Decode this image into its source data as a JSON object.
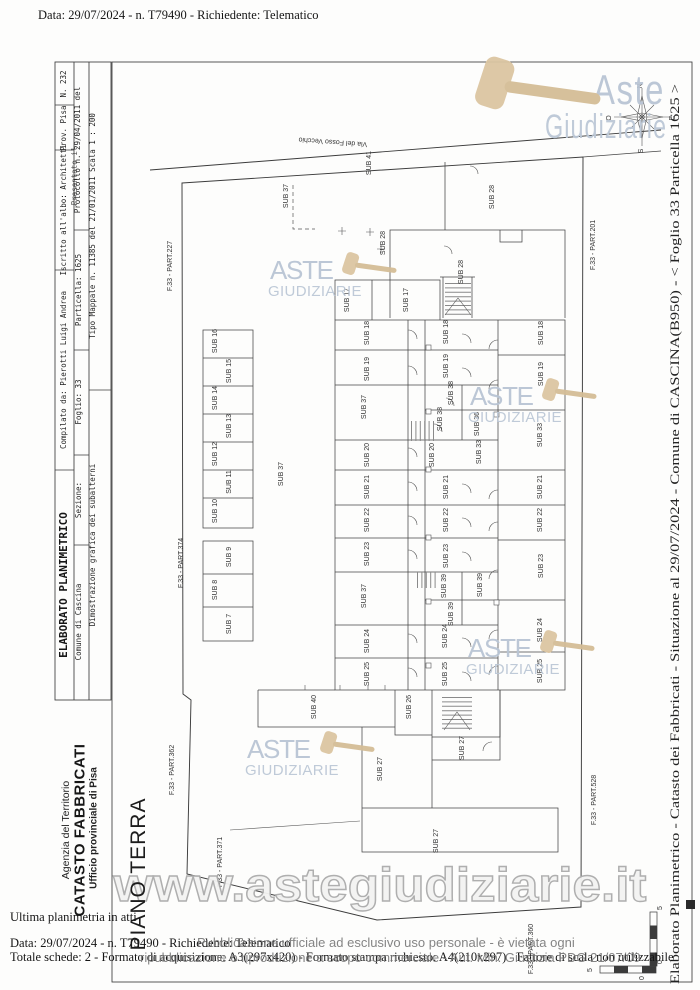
{
  "header": {
    "doc_info": "Data: 29/07/2024 - n. T79490 - Richiedente: Telematico"
  },
  "title_block": {
    "row1": {
      "title": "ELABORATO PLANIMETRICO",
      "compiled_by": "Compilato da: Pierotti Luigi Andrea",
      "registered": "Iscritto all'albo: Architetti",
      "province": "Prov. Pisa",
      "number": "N. 232"
    },
    "row2": {
      "comune": "Comune di Cascina",
      "sezione": "Sezione:",
      "foglio": "Foglio: 33",
      "particella": "Particella: 1625"
    },
    "stamp": {
      "overlay": "Presentato il",
      "text": "Protocollo n. 29/04/2011 del"
    },
    "row3": {
      "desc": "Dimostrazione grafica dei subalterni",
      "tipo_mappale": "Tipo Mappale n. 11385   del 21/01/2011   Scala 1 : 200"
    }
  },
  "agency": {
    "line1": "Agenzia del Territorio",
    "line2": "CATASTO FABBRICATI",
    "line3": "Ufficio provinciale di  Pisa"
  },
  "floor_title": "PIANO TERRA",
  "plan": {
    "road_name": "Via del Fosso Vecchio",
    "labels": [
      {
        "t": "Via del Fosso Vecchio",
        "x": 333,
        "y": 140,
        "r": 184,
        "s": 7
      },
      {
        "t": "SUB 41",
        "x": 371,
        "y": 163
      },
      {
        "t": "SUB 37",
        "x": 288,
        "y": 196
      },
      {
        "t": "SUB 28",
        "x": 494,
        "y": 197
      },
      {
        "t": "SUB 28",
        "x": 385,
        "y": 243,
        "s": 6
      },
      {
        "t": "SUB 28",
        "x": 463,
        "y": 272
      },
      {
        "t": "SUB 17",
        "x": 349,
        "y": 300
      },
      {
        "t": "SUB 17",
        "x": 408,
        "y": 300
      },
      {
        "t": "F.33 - PART.227",
        "x": 172,
        "y": 266
      },
      {
        "t": "F.33 - PART.374",
        "x": 183,
        "y": 563
      },
      {
        "t": "F.33 - PART.362",
        "x": 174,
        "y": 770
      },
      {
        "t": "F.33 - PART.371",
        "x": 222,
        "y": 862
      },
      {
        "t": "F.33 - PART.201",
        "x": 595,
        "y": 245
      },
      {
        "t": "F.33 - PART.528",
        "x": 596,
        "y": 800
      },
      {
        "t": "F.33 - PART.360",
        "x": 533,
        "y": 949
      },
      {
        "t": "SUB 16",
        "x": 217,
        "y": 341
      },
      {
        "t": "SUB 15",
        "x": 231,
        "y": 371
      },
      {
        "t": "SUB 14",
        "x": 217,
        "y": 398
      },
      {
        "t": "SUB 13",
        "x": 231,
        "y": 426
      },
      {
        "t": "SUB 12",
        "x": 217,
        "y": 454
      },
      {
        "t": "SUB 11",
        "x": 231,
        "y": 482
      },
      {
        "t": "SUB 10",
        "x": 217,
        "y": 511
      },
      {
        "t": "SUB 9",
        "x": 231,
        "y": 557
      },
      {
        "t": "SUB 8",
        "x": 217,
        "y": 590
      },
      {
        "t": "SUB 7",
        "x": 231,
        "y": 624
      },
      {
        "t": "SUB 37",
        "x": 283,
        "y": 474,
        "s": 9
      },
      {
        "t": "SUB 18",
        "x": 369,
        "y": 333
      },
      {
        "t": "SUB 18",
        "x": 448,
        "y": 332
      },
      {
        "t": "SUB 18",
        "x": 543,
        "y": 333
      },
      {
        "t": "SUB 19",
        "x": 369,
        "y": 369
      },
      {
        "t": "SUB 19",
        "x": 448,
        "y": 366
      },
      {
        "t": "SUB 19",
        "x": 543,
        "y": 374
      },
      {
        "t": "SUB 37",
        "x": 366,
        "y": 407
      },
      {
        "t": "SUB 38",
        "x": 453,
        "y": 393,
        "s": 6
      },
      {
        "t": "SUB 38",
        "x": 442,
        "y": 419,
        "s": 6
      },
      {
        "t": "SUB 36",
        "x": 479,
        "y": 424,
        "s": 6
      },
      {
        "t": "SUB 33",
        "x": 481,
        "y": 452,
        "s": 6
      },
      {
        "t": "SUB 33",
        "x": 542,
        "y": 435
      },
      {
        "t": "SUB 20",
        "x": 369,
        "y": 455
      },
      {
        "t": "SUB 20",
        "x": 434,
        "y": 455
      },
      {
        "t": "SUB 21",
        "x": 369,
        "y": 487
      },
      {
        "t": "SUB 21",
        "x": 448,
        "y": 487
      },
      {
        "t": "SUB 21",
        "x": 542,
        "y": 487
      },
      {
        "t": "SUB 22",
        "x": 369,
        "y": 520
      },
      {
        "t": "SUB 22",
        "x": 448,
        "y": 520
      },
      {
        "t": "SUB 22",
        "x": 542,
        "y": 520
      },
      {
        "t": "SUB 23",
        "x": 369,
        "y": 554
      },
      {
        "t": "SUB 23",
        "x": 448,
        "y": 556
      },
      {
        "t": "SUB 23",
        "x": 543,
        "y": 566
      },
      {
        "t": "SUB 37",
        "x": 366,
        "y": 596
      },
      {
        "t": "SUB 39",
        "x": 446,
        "y": 586,
        "s": 6
      },
      {
        "t": "SUB 39",
        "x": 482,
        "y": 585,
        "s": 6
      },
      {
        "t": "SUB 39",
        "x": 453,
        "y": 614,
        "s": 6
      },
      {
        "t": "SUB 24",
        "x": 369,
        "y": 641
      },
      {
        "t": "SUB 24",
        "x": 447,
        "y": 636
      },
      {
        "t": "SUB 24",
        "x": 542,
        "y": 630
      },
      {
        "t": "SUB 25",
        "x": 369,
        "y": 674
      },
      {
        "t": "SUB 25",
        "x": 447,
        "y": 674
      },
      {
        "t": "SUB 25",
        "x": 542,
        "y": 671
      },
      {
        "t": "SUB 40",
        "x": 316,
        "y": 707
      },
      {
        "t": "SUB 26",
        "x": 411,
        "y": 707
      },
      {
        "t": "SUB 27",
        "x": 382,
        "y": 769
      },
      {
        "t": "SUB 27",
        "x": 464,
        "y": 748
      },
      {
        "t": "SUB 27",
        "x": 438,
        "y": 841
      },
      {
        "t": "N",
        "x": 642,
        "y": 86,
        "s": 6
      },
      {
        "t": "S",
        "x": 643,
        "y": 151,
        "s": 6
      },
      {
        "t": "E",
        "x": 674,
        "y": 118,
        "s": 6
      },
      {
        "t": "O",
        "x": 611,
        "y": 118,
        "s": 6
      },
      {
        "t": "5",
        "x": 592,
        "y": 970,
        "s": 7
      },
      {
        "t": "0",
        "x": 644,
        "y": 978,
        "s": 7
      },
      {
        "t": "0",
        "x": 662,
        "y": 962,
        "s": 7
      },
      {
        "t": "5",
        "x": 662,
        "y": 908,
        "s": 7
      }
    ]
  },
  "watermarks": {
    "logo_line1": "Aste",
    "logo_line2": "Giudiziarie",
    "small_line1": "ASTE",
    "small_line2": "GIUDIZIARIE",
    "url": "www.astegiudiziarie.it"
  },
  "footer": {
    "line1": "Ultima planimetria in atti",
    "line2": "Data: 29/07/2024 - n. T79490 - Richiedente: Telematico",
    "line3": "Totale schede: 2 - Formato di acquisizione: A3(297x420) - Formato stampa richiesto: A4(210x297) - Fattore di scala non utilizzabile",
    "disclaimer1": "Pubblicazione ufficiale ad esclusivo uso personale - è vietata ogni",
    "disclaimer2": "ripubblicazione o riproduzione a scopo commerciale - Aut. Min. Giustizia PDG 21/07/09"
  },
  "right_margin": "Elaborato Planimetrico - Catasto dei Fabbricati - Situazione al 29/07/2024 - Comune di CASCINA(B950) - < Foglio 33 Particella 1625 >",
  "colors": {
    "watermark_blue": "#b9c5d4",
    "gavel_tan": "#dcc6a2",
    "line_gray": "#454545",
    "disclaimer_gray": "#7a7a7a"
  }
}
